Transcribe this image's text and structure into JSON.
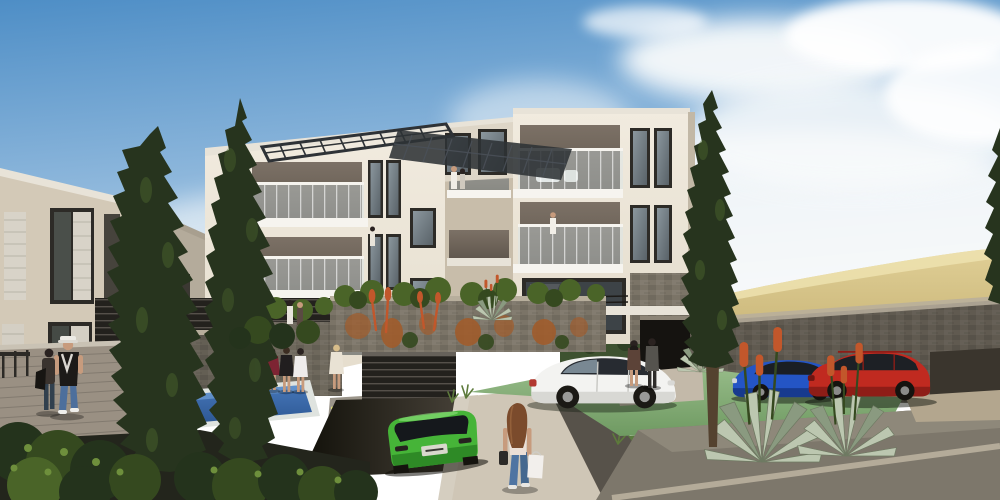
{
  "scene": {
    "type": "3d-architectural-render",
    "label": "Photorealistic rendering of a modern multi-storey apartment complex on a hillside with landscaped grounds, swimming pool, underground garage ramp, parked cars and pedestrians"
  },
  "objects": {
    "scene_label": "Architectural rendering of modern apartment complex",
    "sky": "Blue sky with soft clouds",
    "hill_gold": "Golden dry-grass hillside on the right",
    "hill_green": "Green hillside behind the buildings",
    "left_building": "Neighbouring apartment building with shuttered windows",
    "main_building": "Four-storey cream apartment building with glass balconies and rooftop pergola",
    "penthouse": "Rooftop penthouse volume",
    "pergola": "Dark metal rooftop pergola grid",
    "pool": "Blue swimming pool with white coping",
    "deck": "Timber pool deck",
    "garage": "Underground garage entrance with slatted gate",
    "ramp": "Driveway ramp to garage",
    "steps": "Concrete steps with light nosing",
    "parking": "Green-surfaced parking pad",
    "white_car": "White hatchback parked on green pad",
    "green_car": "Bright green SUV driving down the garage ramp",
    "blue_car": "Blue hatchback parked by the stone wall",
    "red_car": "Red estate car parked by the stone wall",
    "cypress_trees": "Tall Italian cypress trees",
    "agaves": "Silver agave plants with orange flower spikes",
    "people": "Pedestrians walking and residents standing near the pool and balconies",
    "shopper": "Woman with long auburn hair carrying shopping bags",
    "stone_walls": "Grey stone retaining walls with cascading rusty plants"
  },
  "colors": {
    "sky-top": "#4e8ec6",
    "sky-mid": "#8fb8dc",
    "sky-horizon": "#eef2f4",
    "cloud": "#f8fafb",
    "hill-gold-light": "#e0cf96",
    "hill-gold": "#c6b274",
    "hedge-dark": "#3e5230",
    "hill-green": "#7d9a4e",
    "hill-green-dark": "#5a7838",
    "cream-light": "#f1ebdf",
    "cream": "#e4dccc",
    "cream-dark": "#d3c9b7",
    "cream-shadow": "#c8bdaa",
    "recess": "#7c7166",
    "recess-dark": "#5f564c",
    "frame-dark": "#2d2b27",
    "glass-light": "#8b979e",
    "glass-dark": "#596268",
    "rail-white": "#f6f4ef",
    "rail-glass": "#d8e7ec",
    "pergola": "#2e3236",
    "stone": "#7b7467",
    "stone-dark": "#5a544a",
    "stone-cap": "#b7ae9c",
    "rust": "#a05c2c",
    "cypress": "#27341e",
    "cypress-light": "#4d682f",
    "trunk": "#54422f",
    "pool-blue": "#4677b8",
    "pool-deep": "#2d5794",
    "deck": "#9a9083",
    "pave-light": "#cfc6b6",
    "pave-warm": "#c3b9a9",
    "pave-dark": "#7d776b",
    "pave-deep": "#57524a",
    "curb": "#b4ab99",
    "park-green-l": "#96bb88",
    "park-green": "#6f9a62",
    "lawn": "#5a7a3e",
    "car-white": "#f3f3f1",
    "car-green": "#46b438",
    "car-green-dark": "#2e8a26",
    "car-blue": "#2455c5",
    "car-blue-dark": "#173a8e",
    "car-red": "#c02a20",
    "car-red-dark": "#8e1d17",
    "agave": "#bcc7b0",
    "agave-dark": "#8a9a80",
    "flower": "#c2572b",
    "skin": "#c79b7d",
    "jeans": "#4d6f9c",
    "hair-dark": "#2a2220",
    "blonde": "#d8bd8a",
    "auburn": "#7b4b2c",
    "soil": "#403529",
    "bush-dark": "#24331c",
    "bush-mid": "#35491f",
    "bush-light": "#4a6428",
    "leaf-hi": "#6e8f3c",
    "slat-dark": "#23211d",
    "slat-line": "#55504a",
    "white-slab": "#e8e3d8",
    "dark-opening": "#151310"
  }
}
